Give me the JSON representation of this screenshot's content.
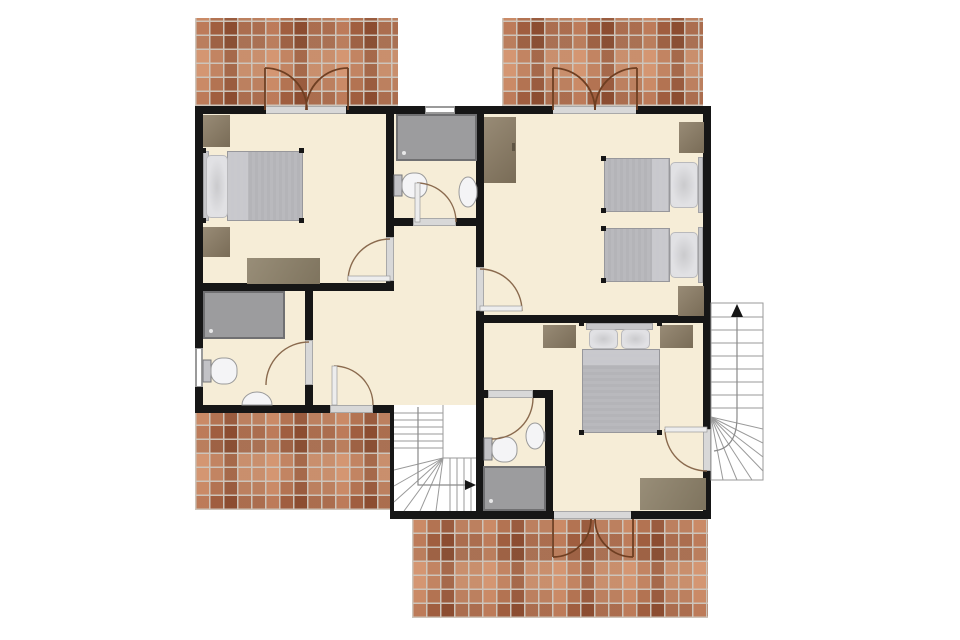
{
  "title": "second-floor-apartment-floor-plan",
  "colors": {
    "floor": "#f6edd7",
    "wall": "#161616",
    "sill": "#d8d8d8",
    "sill_border": "#a9a9a9",
    "window": "#ffffff",
    "brick_base": "#b37352",
    "brick_grout": "#cdc4ba",
    "wood": "#8a7b63",
    "wood_dark": "#5f5544",
    "rug": "#8d8169",
    "mattress": "#b4b4b8",
    "mattress_fold": "#c9c9cd",
    "pillow": "#e1e1e4",
    "headboard": "#c6c6c9",
    "fixture": "#9c9c9e",
    "fixture_border": "#707072",
    "porcelain": "#f4f4f6",
    "porcelain_border": "#9a9a9a",
    "tank": "#c2c2c6",
    "door_arc": "#8a6a4e",
    "french_arc": "#6f3f22",
    "stair_line": "#9a9a9a",
    "walk_line": "#8a8a8a",
    "stair_bg": "#ffffff"
  },
  "terraces": [
    {
      "name": "terrace-top-left"
    },
    {
      "name": "terrace-top-right"
    },
    {
      "name": "terrace-bottom-left"
    },
    {
      "name": "terrace-bottom-center"
    }
  ],
  "rooms": [
    {
      "name": "bedroom-top-left",
      "furniture": [
        "wardrobe",
        "double-bed",
        "nightstand",
        "rug"
      ],
      "doors": [
        "french-doors-to-terrace",
        "door-to-hallway"
      ]
    },
    {
      "name": "bathroom-top-middle",
      "furniture": [
        "bathtub-shower",
        "toilet",
        "sink"
      ],
      "doors": [
        "door-to-hallway"
      ],
      "windows": 1
    },
    {
      "name": "bedroom-top-right",
      "furniture": [
        "wardrobe",
        "twin-bed",
        "twin-bed",
        "nightstand",
        "nightstand"
      ],
      "doors": [
        "french-doors-to-terrace",
        "door-to-hallway"
      ]
    },
    {
      "name": "bedroom-bottom-right",
      "furniture": [
        "double-bed",
        "nightstand",
        "nightstand",
        "rug"
      ],
      "doors": [
        "french-doors-to-terrace",
        "door-to-exterior-stairs",
        "door-to-ensuite"
      ]
    },
    {
      "name": "ensuite-bathroom",
      "furniture": [
        "shower",
        "toilet",
        "sink"
      ],
      "doors": [
        "door-to-bedroom"
      ]
    },
    {
      "name": "bathroom-bottom-left",
      "furniture": [
        "shower",
        "toilet",
        "sink"
      ],
      "doors": [
        "door-to-hallway"
      ],
      "windows": 1
    },
    {
      "name": "hallway",
      "furniture": [],
      "doors": [
        "door-to-terrace"
      ]
    },
    {
      "name": "interior-staircase",
      "direction_arrow": "right"
    },
    {
      "name": "exterior-staircase",
      "direction_arrow": "up"
    }
  ]
}
